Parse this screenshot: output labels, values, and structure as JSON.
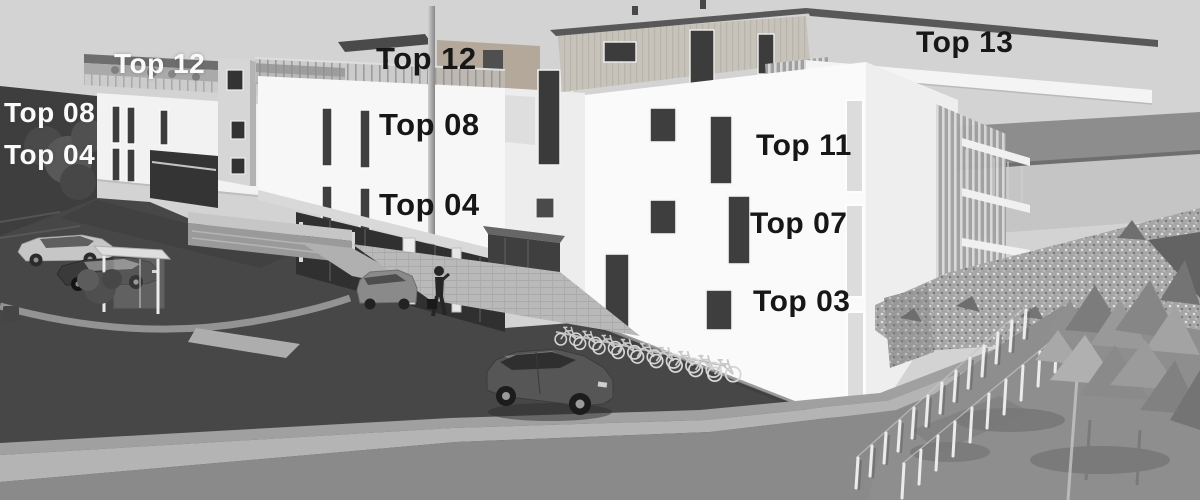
{
  "labels": [
    {
      "id": "top-12-left",
      "text": "Top 12",
      "style": "light"
    },
    {
      "id": "top-08-left",
      "text": "Top 08",
      "style": "light"
    },
    {
      "id": "top-04-left",
      "text": "Top 04",
      "style": "light"
    },
    {
      "id": "top-12-center",
      "text": "Top 12",
      "style": "dark"
    },
    {
      "id": "top-08-center",
      "text": "Top 08",
      "style": "dark"
    },
    {
      "id": "top-04-center",
      "text": "Top 04",
      "style": "dark"
    },
    {
      "id": "top-13-right",
      "text": "Top 13",
      "style": "dark"
    },
    {
      "id": "top-11-right",
      "text": "Top 11",
      "style": "dark"
    },
    {
      "id": "top-07-right",
      "text": "Top 07",
      "style": "dark"
    },
    {
      "id": "top-03-right",
      "text": "Top 03",
      "style": "dark"
    }
  ],
  "colors": {
    "sky": "#d3d3d3",
    "facade_white": "#f7f7f7",
    "penthouse_wood": "#c7c3ba",
    "roof_fascia": "#585858",
    "asphalt": "#474747",
    "sidewalk": "#a0a0a0",
    "dark_wall": "#3e3e3e",
    "glass": "#303030",
    "label_light": "#fafafa",
    "label_dark": "#171717"
  },
  "scene": {
    "type": "grayscale-architectural-3d-rendering",
    "bicycle_count": 9,
    "objects": [
      "left-apartment-building",
      "stair-tower",
      "center-apartment-building",
      "right-apartment-building",
      "penthouse-level",
      "roof-terrace-railing",
      "parasol",
      "flag-pole",
      "ground-floor-glazing",
      "entrance-box",
      "entrance-door",
      "bus-stop-shelter",
      "shrub",
      "light-sedan",
      "dark-sedan",
      "gray-minivan",
      "dark-hatchback",
      "pedestrian",
      "bicycle-rack",
      "gabion-rock-wall",
      "gravel-bed",
      "low-poly-trees",
      "picket-fence",
      "street",
      "sidewalk"
    ]
  }
}
